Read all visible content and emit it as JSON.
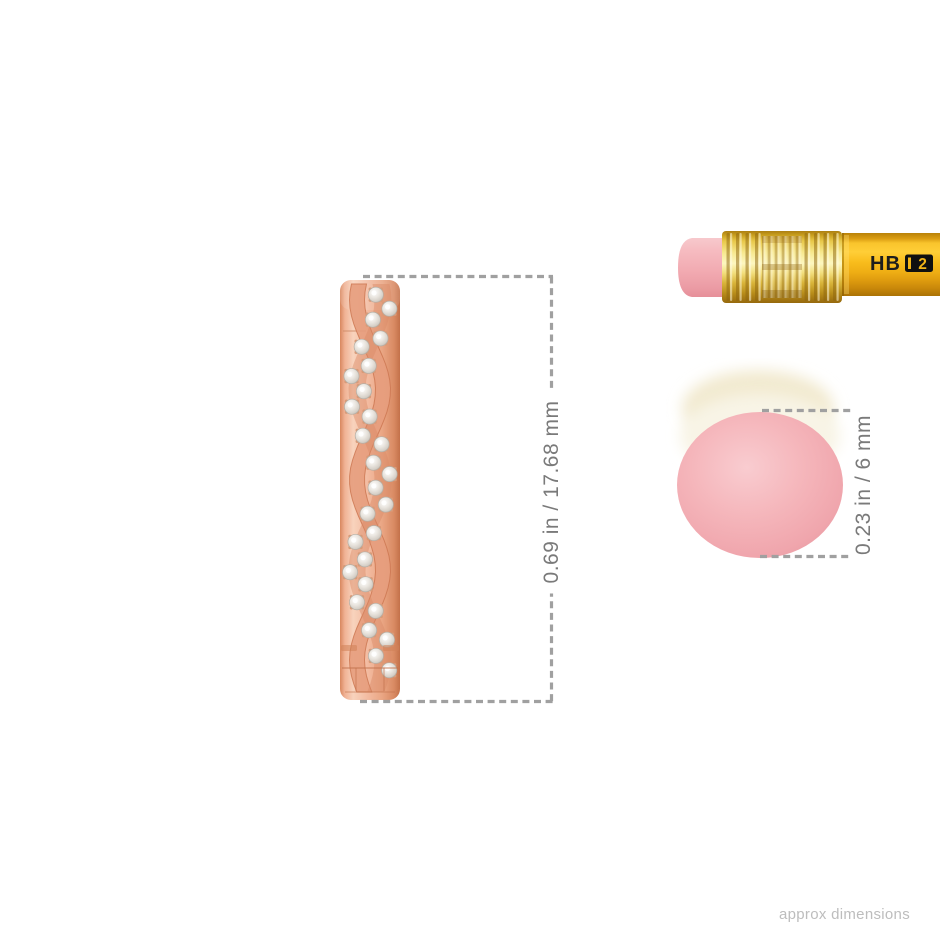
{
  "page": {
    "background_color": "#ffffff",
    "footer_note": "approx dimensions"
  },
  "measurements": {
    "earring_height": "0.69 in / 17.68 mm",
    "eraser_diameter": "0.23 in / 6 mm",
    "dash_color": "#a0a0a0",
    "label_color": "#7a7a7a"
  },
  "earring": {
    "description": "rose gold twisted pave diamond hoop earring, side view",
    "metal_color": "#eda98c",
    "metal_highlight": "#f8d3bd",
    "metal_shadow": "#c3714a",
    "diamond_color": "#eae6e0",
    "stone_count": 28
  },
  "pencil": {
    "grade_label": "HB",
    "grade_number": "2",
    "body_color": "#f2b517",
    "ferrule_color": "#e8c84a",
    "eraser_color": "#f2abb2"
  },
  "eraser_end": {
    "color": "#f5b6bb"
  }
}
